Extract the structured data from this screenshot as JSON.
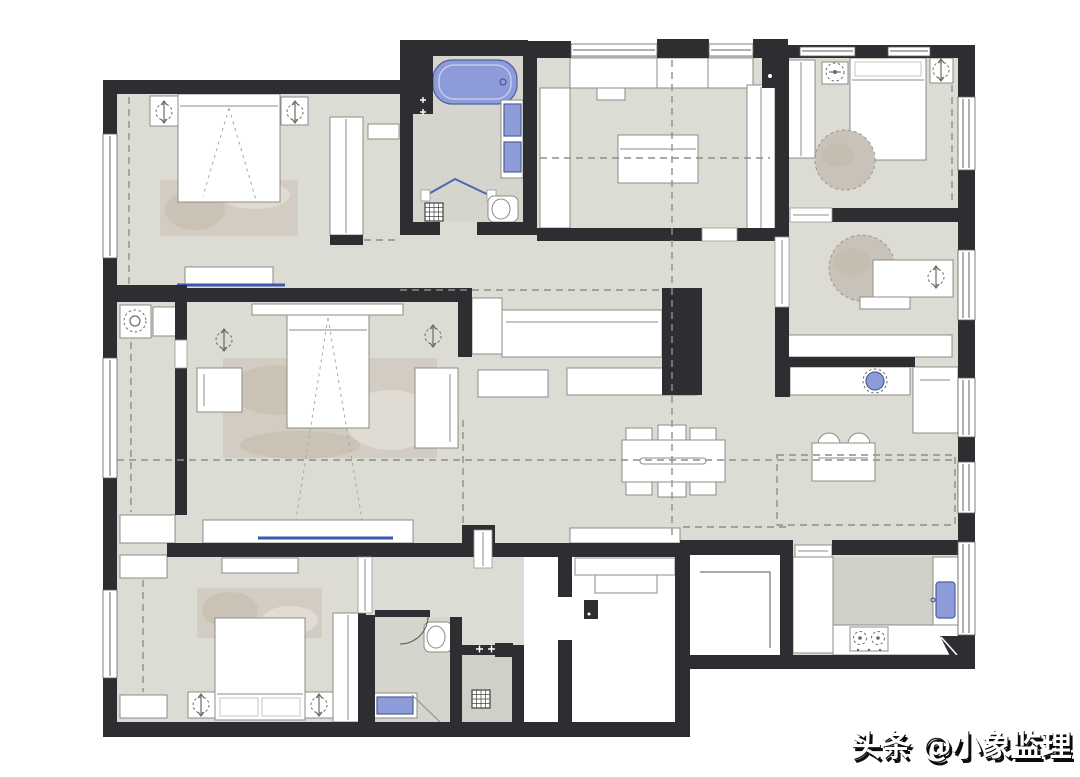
{
  "watermark": {
    "text": "头条 @小象监理"
  },
  "palette": {
    "wall": "#2d2e31",
    "floor": "#dcdcd5",
    "floorBath": "#d5d5ce",
    "floorDark": "#d0d0c9",
    "furniture": "#ffffff",
    "furnitureLine": "#8d8d86",
    "accentBlue": "#8e9bd9",
    "accentBlueDeep": "#4e5f9e",
    "rug": "#d3ccc2",
    "roundRug": "#c9c2b8",
    "dashGuide": "#8f8f88",
    "watermarkFill": "#ffffff",
    "watermarkShadow": "#0c0c0c",
    "background": "#ffffff"
  },
  "plan": {
    "type": "apartment-floor-plan",
    "rooms": [
      {
        "name": "bedroom-top-left",
        "furniture": [
          "double-bed",
          "nightstand-left",
          "nightstand-right",
          "pendant-lamp",
          "area-rug",
          "wardrobe",
          "tv-console",
          "tv-line"
        ]
      },
      {
        "name": "master-bathroom",
        "furniture": [
          "bathtub",
          "double-vanity-sinks",
          "toilet",
          "floor-drain",
          "glass-partition"
        ]
      },
      {
        "name": "study-room",
        "furniture": [
          "wall-cabinets",
          "tall-cabinet-left",
          "tall-cabinet-right",
          "center-table"
        ]
      },
      {
        "name": "bedroom-top-right",
        "furniture": [
          "single-bed",
          "nightstand-left",
          "nightstand-right",
          "wardrobe",
          "round-rug"
        ]
      },
      {
        "name": "home-office",
        "furniture": [
          "desk",
          "desk-lamp",
          "round-rug",
          "low-cabinet"
        ]
      },
      {
        "name": "master-bedroom",
        "furniture": [
          "double-bed",
          "headboard",
          "pendant-lamp-left",
          "pendant-lamp-right",
          "armchair",
          "dresser",
          "area-rug",
          "tv-console",
          "tv-line"
        ]
      },
      {
        "name": "laundry-balcony",
        "furniture": [
          "washing-machine",
          "counter",
          "storage-cabinet"
        ]
      },
      {
        "name": "living-dining-room",
        "furniture": [
          "dining-table",
          "dining-chairs",
          "hall-cabinet",
          "sideboard-left",
          "sideboard-right",
          "shoe-cabinet"
        ]
      },
      {
        "name": "bar-corridor",
        "furniture": [
          "bar-counter",
          "round-basin",
          "refrigerator",
          "tea-table",
          "chairs"
        ]
      },
      {
        "name": "kitchen",
        "furniture": [
          "counters",
          "gas-stove",
          "sink",
          "corner-shelf",
          "sliding-door"
        ]
      },
      {
        "name": "bedroom-bottom-left",
        "furniture": [
          "double-bed",
          "nightstand-left",
          "nightstand-right",
          "area-rug",
          "wardrobe",
          "closet-strip",
          "top-cabinet"
        ]
      },
      {
        "name": "guest-bathroom",
        "furniture": [
          "toilet",
          "vanity-sink"
        ]
      },
      {
        "name": "shower-room",
        "furniture": [
          "floor-drain"
        ]
      },
      {
        "name": "entry-foyer",
        "furniture": [
          "bench",
          "shelf",
          "entry-door"
        ]
      },
      {
        "name": "stairwell",
        "furniture": [
          "stair-line"
        ]
      }
    ]
  }
}
